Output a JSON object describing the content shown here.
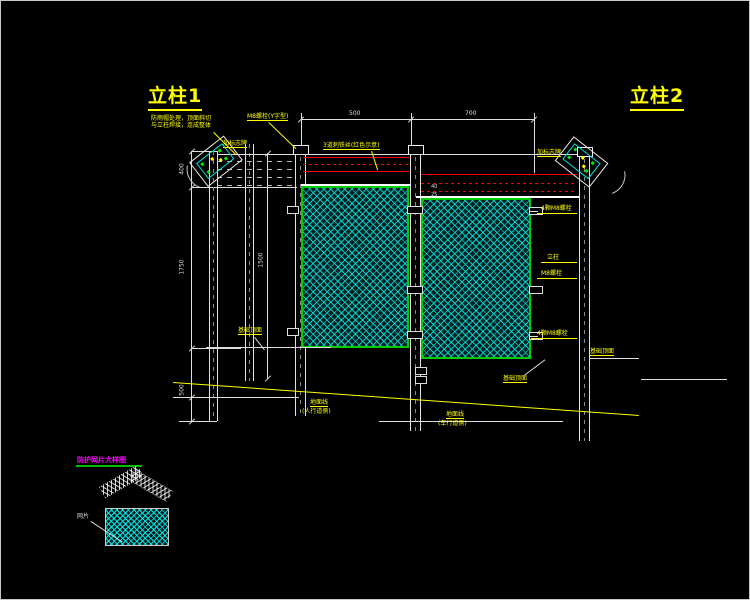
{
  "titles": {
    "column1": "立柱1",
    "column2": "立柱2"
  },
  "notes": {
    "cap_note_line1": "防雨帽处理，顶面斜切",
    "cap_note_line2": "与立柱焊接，连成整体",
    "sign_left": "加标志牌",
    "cap_bolt": "M8螺栓(Y字型)",
    "barbed_wire": "3道刺铁丝(红色示意)",
    "sign_right": "加标志牌"
  },
  "callouts": {
    "bolt1": "4颗M8螺栓",
    "bolt2": "立柱",
    "bolt3": "M8螺栓",
    "bolt4": "4颗M8螺栓",
    "foundation_left": "基础顶面",
    "foundation_mid": "基础顶面",
    "foundation_right": "基础顶面",
    "ground_left": "地面线",
    "ground_left_side": "(人行道侧)",
    "ground_right": "地面线",
    "ground_right_side": "(车行道侧)"
  },
  "dimensions": {
    "top_span1": "500",
    "top_span2": "700",
    "left_seg1": "400",
    "left_seg2": "1750",
    "left_seg3": "500",
    "panel_height": "1500",
    "gap1": "40",
    "gap2": "25"
  },
  "detail_view": {
    "title": "防护网片大样图",
    "mesh_label": "网片"
  },
  "colors": {
    "background": "#000000",
    "line": "#E8E8E8",
    "annotation": "#FFFF00",
    "barbed_wire": "#FF0000",
    "panel_frame": "#00CC00",
    "mesh": "#00E0E0",
    "detail_title": "#FF00FF"
  }
}
